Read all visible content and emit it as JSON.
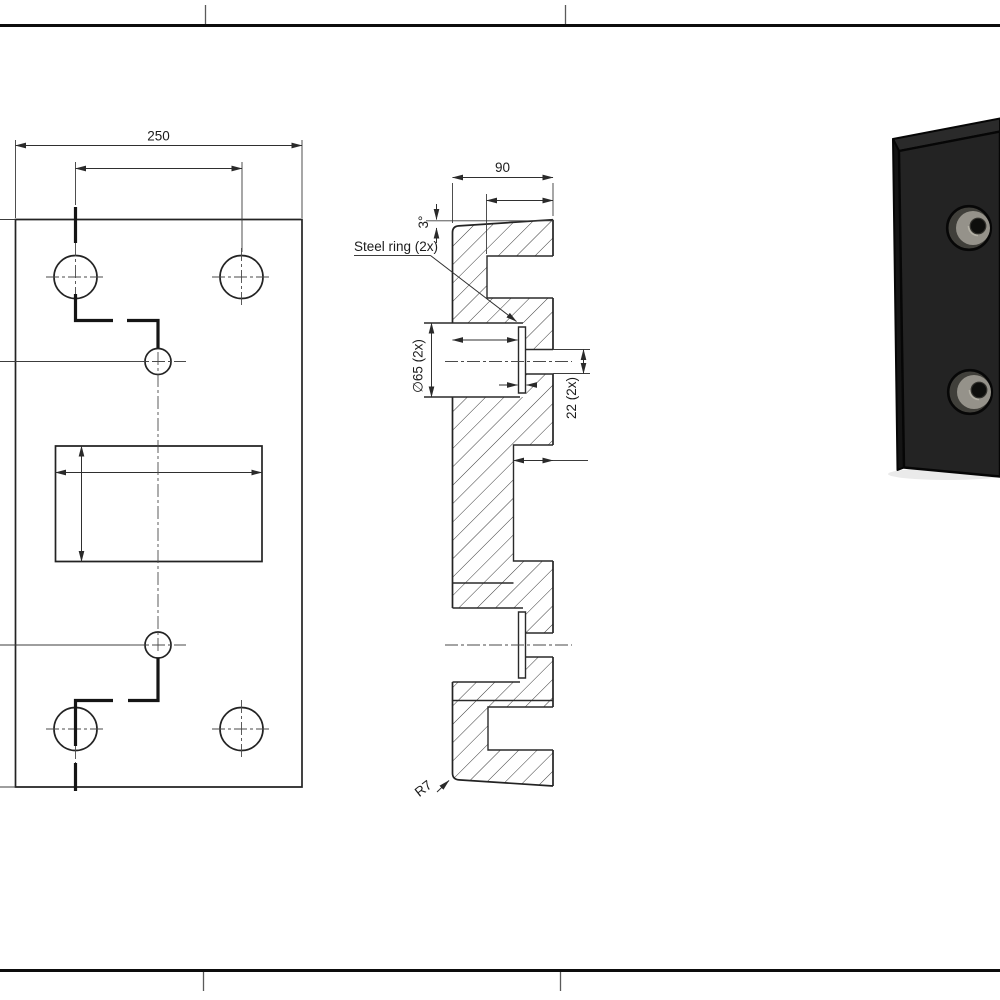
{
  "labels": {
    "front_width": "250",
    "section_width": "90",
    "draft_angle": "3°",
    "steel_ring": "Steel ring (2x)",
    "bore_diameter": "∅65 (2x)",
    "pin_hole": "22 (2x)",
    "corner_radius": "R7"
  },
  "colors": {
    "background": "#ffffff",
    "line": "#2b2b2b",
    "hatch": "#3a3a3a",
    "frame": "#0d0d0d",
    "block_front": "#232323",
    "block_top": "#2a2a2a",
    "block_side": "#141414",
    "bore_wall": "#403f3a",
    "bore_cone": "#95928a",
    "pin_hole_color": "#0e0e0c"
  }
}
